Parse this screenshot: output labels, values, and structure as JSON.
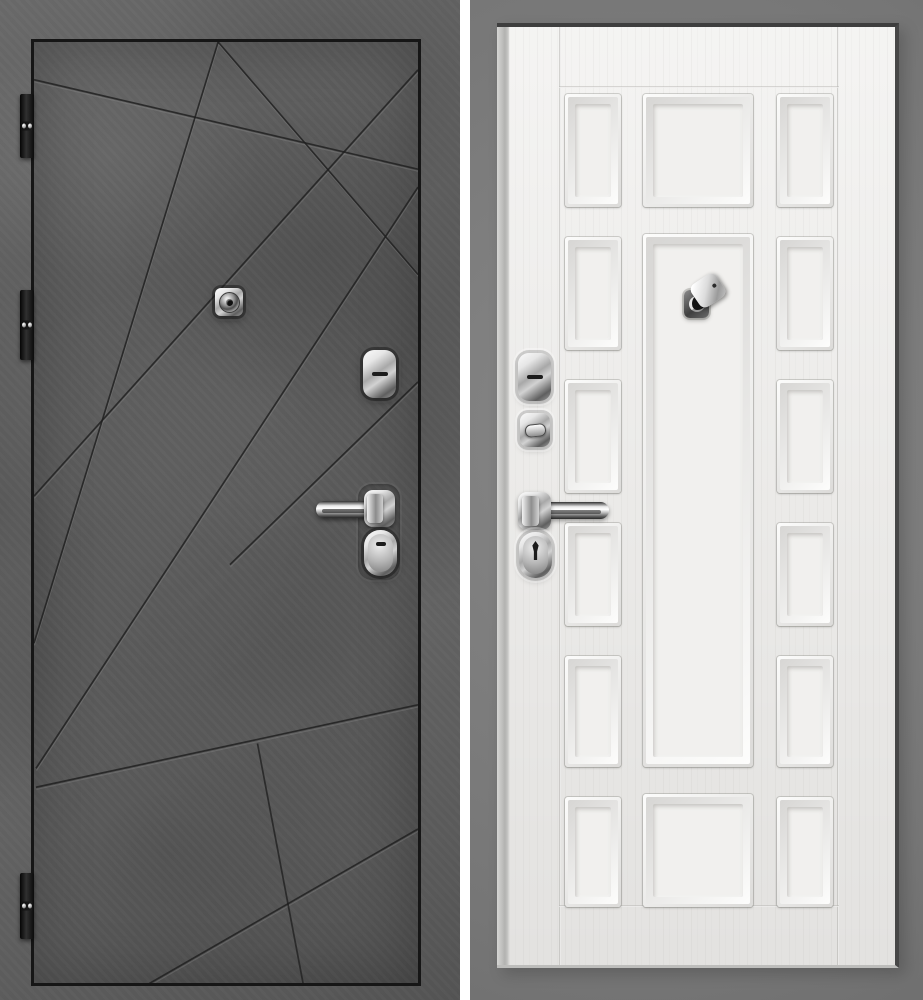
{
  "scene": {
    "type": "door-product-photo",
    "sides": [
      {
        "id": "exterior",
        "finish": "dark-concrete-with-diagonal-grooves",
        "hinge_count": 3,
        "hardware": [
          "peephole",
          "keyhole-escutcheon",
          "lever-handle",
          "cylinder-lock"
        ]
      },
      {
        "id": "interior",
        "finish": "white-classic-raised-panels",
        "panel_columns": 3,
        "side_panel_rows": 6,
        "hardware": [
          "keyhole-escutcheon",
          "thumb-turn",
          "lever-handle",
          "cylinder-lock",
          "peephole-with-cover"
        ]
      }
    ]
  },
  "colors": {
    "concrete_base": "#5f5f5f",
    "concrete_leaf": "#5a5a5a",
    "door_outline": "#161616",
    "groove_dark": "#1f1f1f",
    "groove_light": "#999999",
    "right_bg": "#7a7a7a",
    "leaf_white": "#efeeec",
    "panel_shadow": "#c9c8c6",
    "chrome_light": "#f8f8f8",
    "chrome_mid": "#a8a8a8",
    "chrome_dark": "#5f5f5f",
    "hinge_black": "#0d0d0d",
    "divider_white": "#ffffff",
    "keyhole_dark": "#1c1c1c"
  }
}
